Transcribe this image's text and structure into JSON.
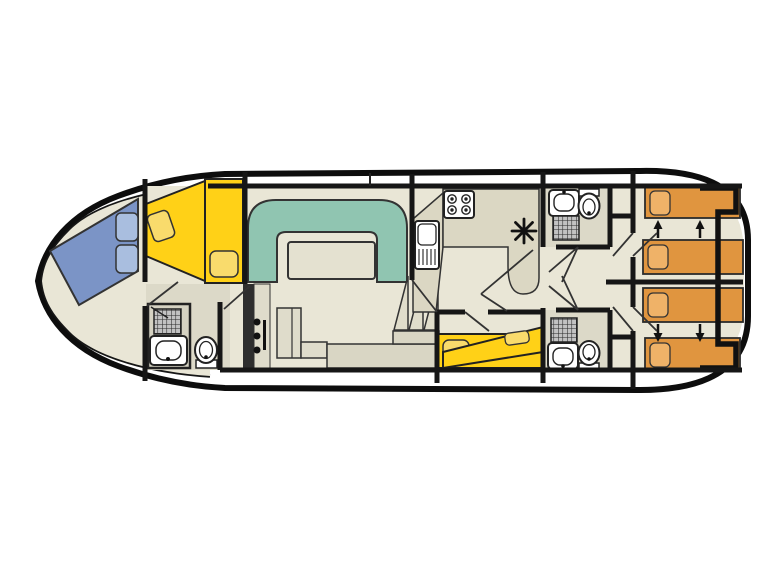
{
  "colors": {
    "hull_outline": "#0d0d0d",
    "wall": "#161616",
    "floor": "#E9E6D6",
    "floor_bathroom": "#DCD9C8",
    "shower_stall": "#D5D2C2",
    "counter": "#DBD7C3",
    "furniture": "#DFDCCB",
    "sideboard": "#D9D6C4",
    "stairs": "#E0DDCB",
    "sofa": "#90C5B1",
    "table": "#E4E1D0",
    "bed_blue": "#7B94C6",
    "pillow_blue": "#A9BEDF",
    "bed_yellow": "#FFD117",
    "pillow_yellow": "#F9DB6C",
    "bed_orange": "#E0953F",
    "pillow_orange": "#EFB268",
    "fixture_white": "#FFFFFF",
    "shower_grid_bg": "#C2C2C2",
    "panel_dark": "#2E2E2E",
    "mark_black": "#111111"
  },
  "boat": {
    "type": "houseboat-floor-plan",
    "orientation": "bow-left-stern-right",
    "rooms": [
      {
        "id": "bow-cabin",
        "beds": [
          "v-berth-blue",
          "berth-yellow"
        ],
        "pillows": 4,
        "furniture": [
          "wardrobe"
        ]
      },
      {
        "id": "forward-bathroom",
        "fixtures": [
          "shower",
          "washbasin",
          "toilet"
        ]
      },
      {
        "id": "salon",
        "furniture": [
          "u-shaped-sofa",
          "table",
          "dresser-panel",
          "cabinet",
          "sideboard",
          "steps"
        ]
      },
      {
        "id": "galley",
        "fixtures": [
          "four-burner-stove",
          "sink-with-drainer",
          "worktop",
          "vent-mark"
        ]
      },
      {
        "id": "mid-cabin",
        "beds": [
          "double-berth-yellow"
        ],
        "pillows": 2
      },
      {
        "id": "aft-bathroom-top",
        "fixtures": [
          "washbasin",
          "toilet",
          "shower"
        ]
      },
      {
        "id": "aft-bathroom-bottom",
        "fixtures": [
          "shower",
          "washbasin",
          "toilet"
        ]
      },
      {
        "id": "stern-cabin-top",
        "beds": [
          "single-berth-orange",
          "single-berth-orange"
        ],
        "pillows": 2,
        "arrows": "slide-together"
      },
      {
        "id": "stern-cabin-bottom",
        "beds": [
          "single-berth-orange",
          "single-berth-orange"
        ],
        "pillows": 2,
        "arrows": "slide-together"
      }
    ]
  }
}
